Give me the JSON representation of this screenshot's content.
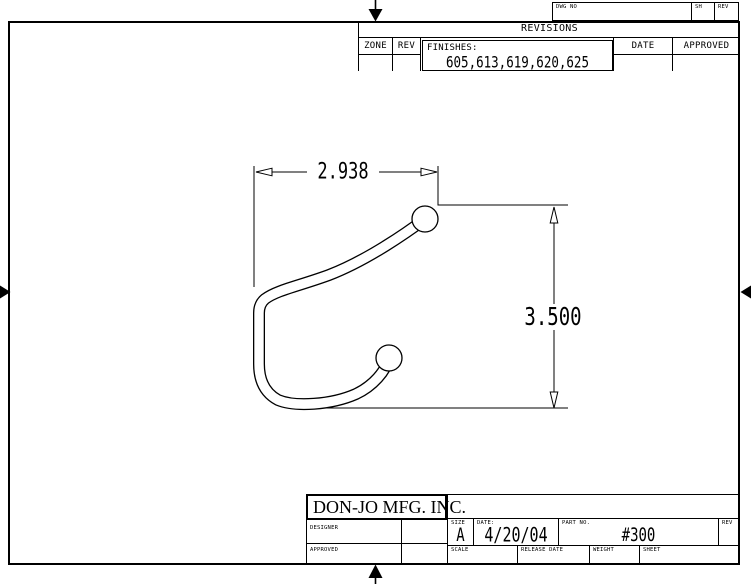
{
  "colors": {
    "line": "#000000",
    "background": "#ffffff"
  },
  "sheet_header": {
    "dwg_no_label": "DWG NO",
    "sh_label": "SH",
    "rev_label": "REV"
  },
  "revisions": {
    "title": "REVISIONS",
    "zone_label": "ZONE",
    "rev_label": "REV",
    "date_label": "DATE",
    "approved_label": "APPROVED",
    "finishes_label": "FINISHES:",
    "finishes_values": "605,613,619,620,625"
  },
  "drawing": {
    "width_dimension": "2.938",
    "height_dimension": "3.500"
  },
  "title_block": {
    "company": "DON-JO MFG. INC.",
    "designer_label": "DESIGNER",
    "approved_label": "APPROVED",
    "size_label": "SIZE",
    "size_value": "A",
    "date_label": "DATE:",
    "date_value": "4/20/04",
    "part_no_label": "PART NO.",
    "part_no_value": "#300",
    "rev_label": "REV",
    "scale_label": "SCALE",
    "release_date_label": "RELEASE DATE",
    "weight_label": "WEIGHT",
    "sheet_label": "SHEET"
  }
}
